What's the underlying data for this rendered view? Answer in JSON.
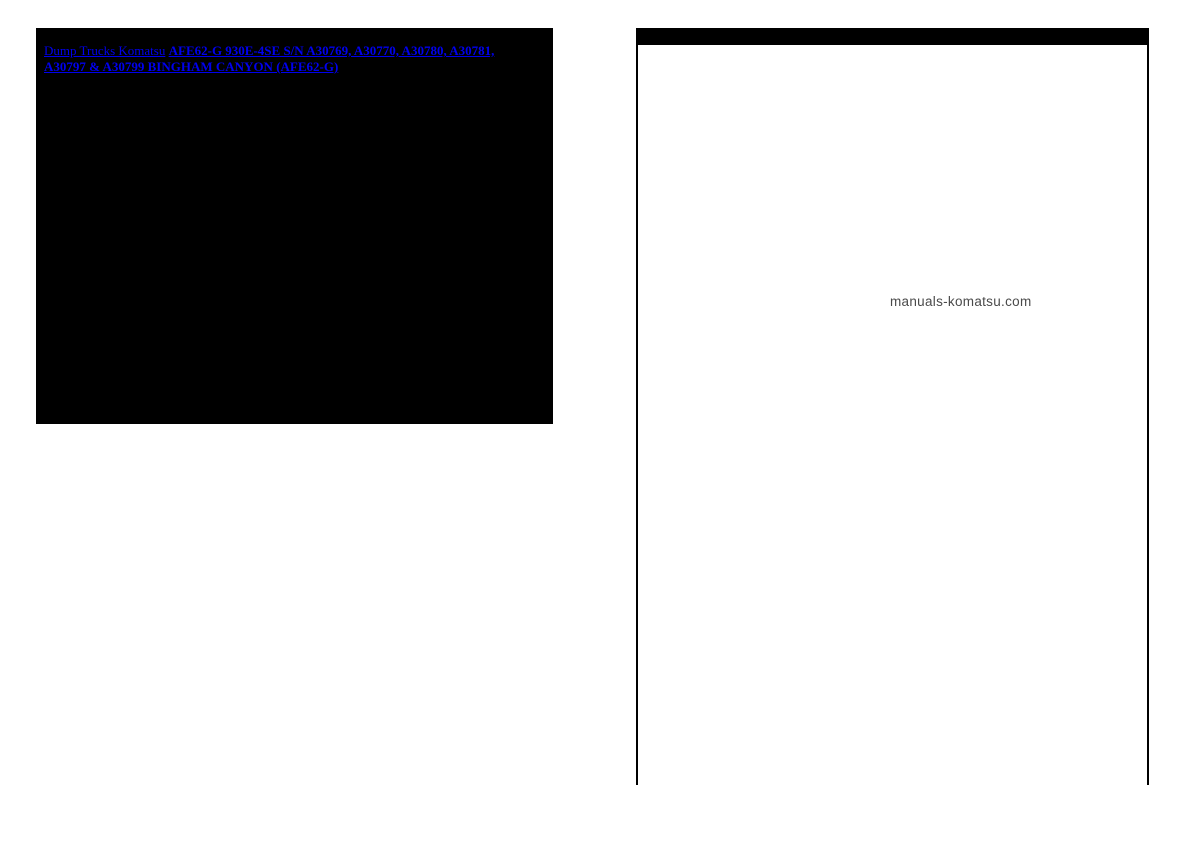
{
  "left_panel": {
    "bg_color": "#000000",
    "link_color": "#0000EE",
    "links": [
      {
        "label": "Dump Trucks Komatsu",
        "bold": false
      },
      {
        "label": "AFE62-G 930E-4SE S/N A30769, A30770, A30780, A30781, A30797 & A30799 BINGHAM CANYON (AFE62-G)",
        "bold": true
      }
    ]
  },
  "diagram": {
    "header_bar_color": "#000000",
    "watermark": "manuals-komatsu.com",
    "watermark_color": "#4a4a4a",
    "callout_color": "#0000EE",
    "callout_radius": 8.3,
    "callouts": [
      {
        "label": "6",
        "x": 792,
        "y": 94
      },
      {
        "label": "7",
        "x": 809,
        "y": 94
      },
      {
        "label": "8",
        "x": 826,
        "y": 94
      },
      {
        "label": "9",
        "x": 843,
        "y": 94
      },
      {
        "label": "5",
        "x": 888,
        "y": 132
      },
      {
        "label": "9",
        "x": 905,
        "y": 132
      },
      {
        "label": "10",
        "x": 922,
        "y": 132
      },
      {
        "label": "11",
        "x": 939,
        "y": 132
      },
      {
        "label": "15",
        "x": 781,
        "y": 213
      },
      {
        "label": "11",
        "x": 912,
        "y": 421
      },
      {
        "label": "12",
        "x": 929,
        "y": 421
      },
      {
        "label": "13",
        "x": 946,
        "y": 421
      },
      {
        "label": "14",
        "x": 963,
        "y": 421
      },
      {
        "label": "2",
        "x": 912,
        "y": 477
      },
      {
        "label": "3",
        "x": 929,
        "y": 477
      },
      {
        "label": "4",
        "x": 946,
        "y": 477
      },
      {
        "label": "7",
        "x": 912,
        "y": 529
      },
      {
        "label": "8",
        "x": 929,
        "y": 529
      },
      {
        "label": "9",
        "x": 946,
        "y": 529
      },
      {
        "label": "1",
        "x": 689,
        "y": 565
      }
    ],
    "leader_lines": [
      {
        "x1": 787,
        "y1": 101,
        "x2": 734,
        "y2": 161
      },
      {
        "x1": 884,
        "y1": 139,
        "x2": 857,
        "y2": 205
      },
      {
        "x1": 781,
        "y1": 222,
        "x2": 791,
        "y2": 331
      },
      {
        "x1": 843,
        "y1": 352,
        "x2": 906,
        "y2": 415
      },
      {
        "x1": 843,
        "y1": 420,
        "x2": 906,
        "y2": 471
      },
      {
        "x1": 838,
        "y1": 442,
        "x2": 906,
        "y2": 523
      },
      {
        "x1": 696,
        "y1": 561,
        "x2": 746,
        "y2": 534
      }
    ]
  }
}
